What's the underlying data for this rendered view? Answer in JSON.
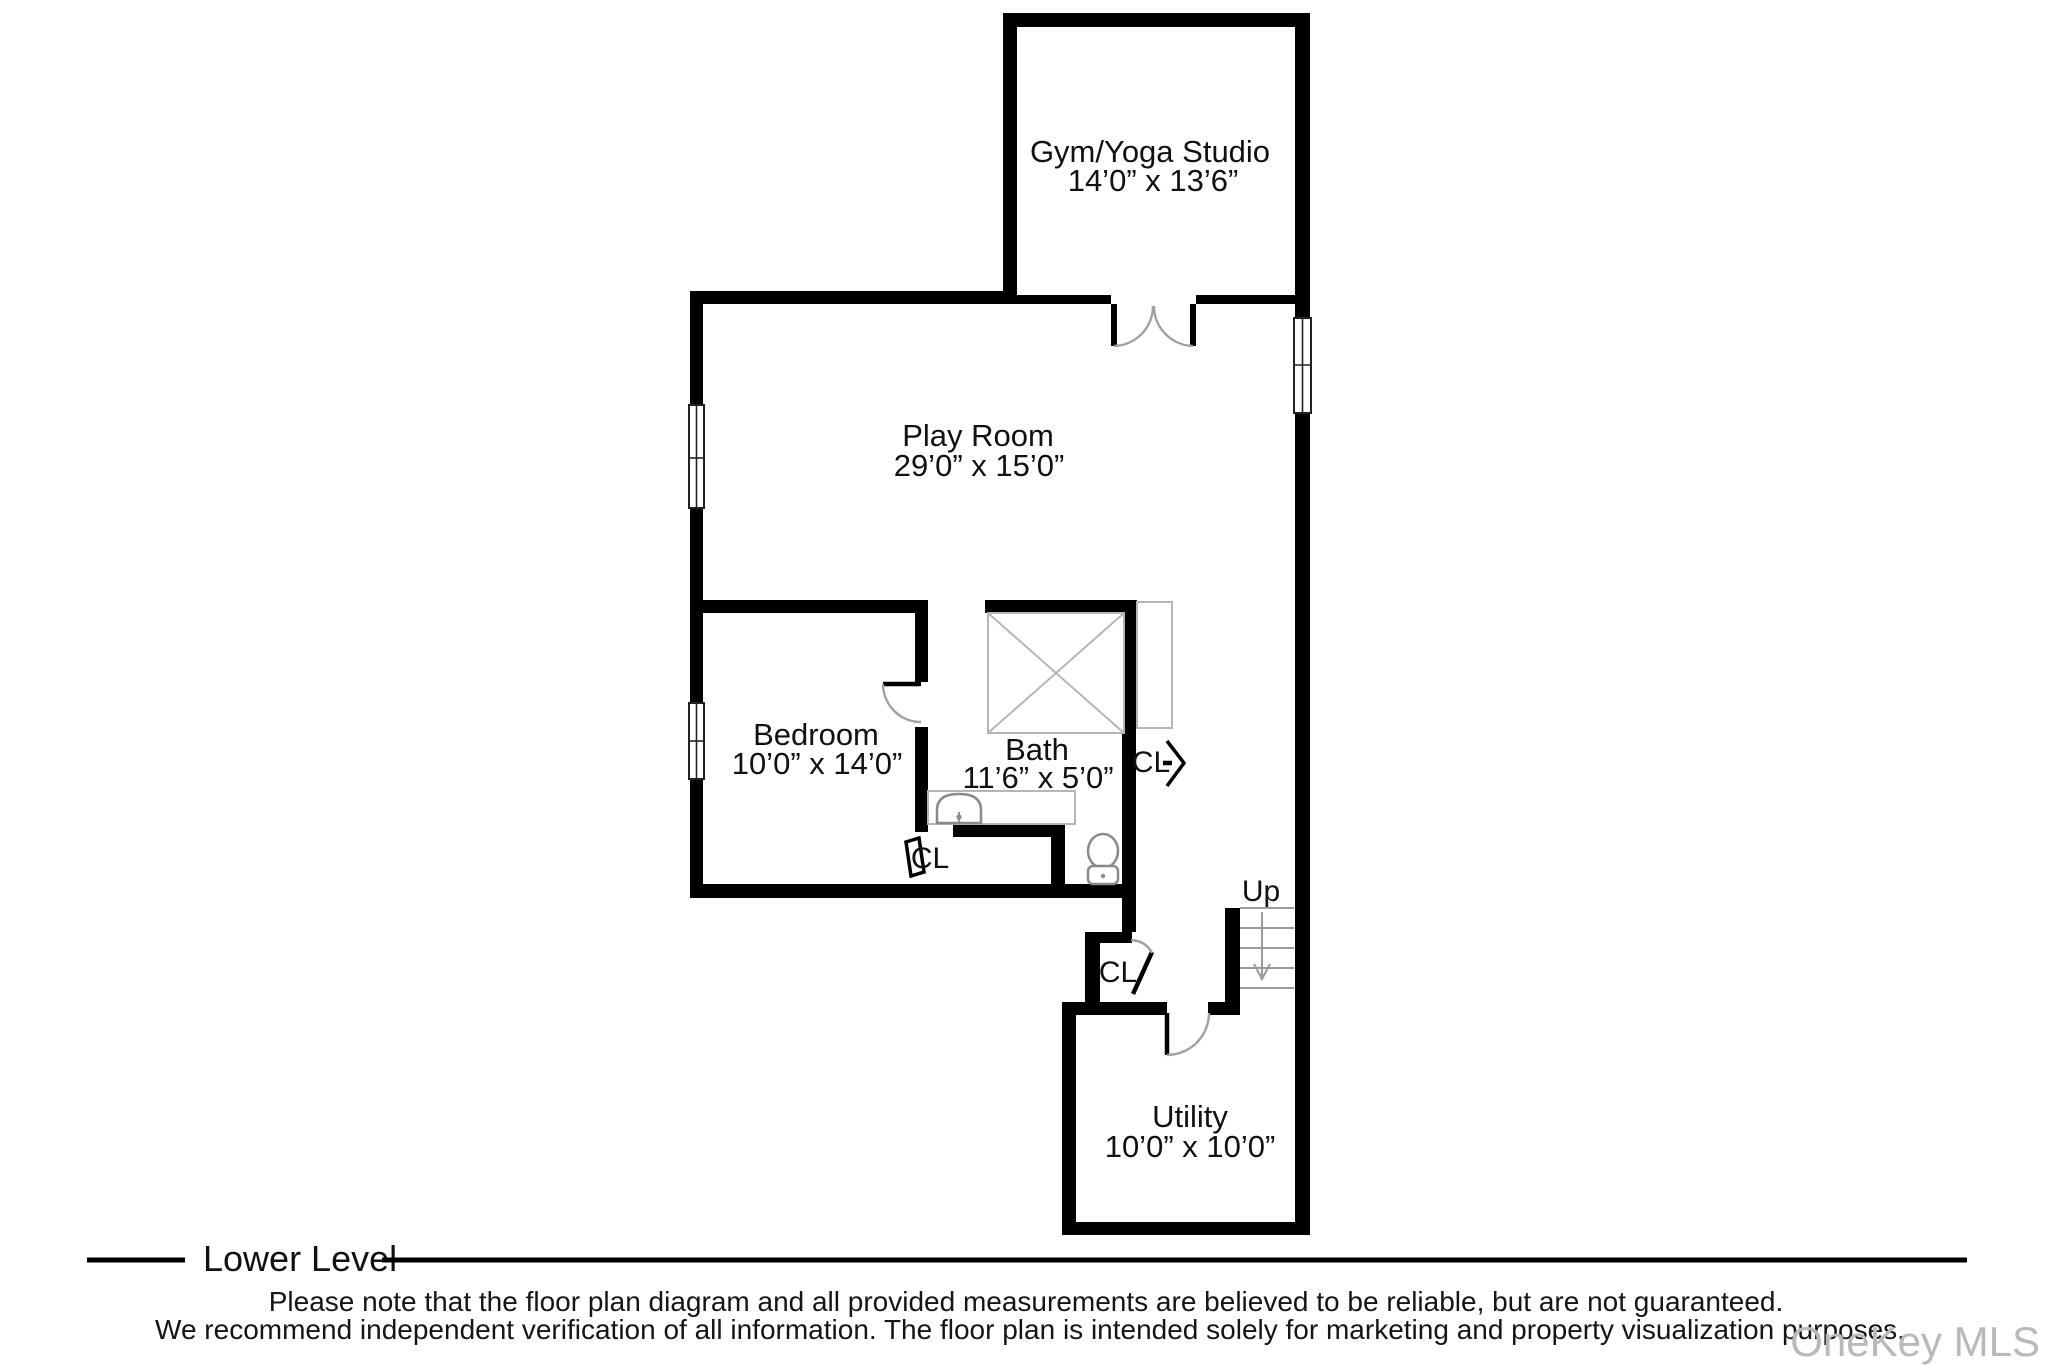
{
  "rooms": {
    "gym": {
      "name": "Gym/Yoga Studio",
      "dims": "14’0” x 13’6”"
    },
    "play": {
      "name": "Play Room",
      "dims": "29’0” x 15’0”"
    },
    "bedroom": {
      "name": "Bedroom",
      "dims": "10’0” x 14’0”"
    },
    "bath": {
      "name": "Bath",
      "dims": "11’6” x 5’0”"
    },
    "utility": {
      "name": "Utility",
      "dims": "10’0” x 10’0”"
    }
  },
  "annotations": {
    "closet_label": "CL",
    "stairs_up_label": "Up"
  },
  "footer": {
    "level_title": "Lower Level",
    "disclaimer_line1": "Please note that the floor plan diagram and all provided measurements are believed to be reliable, but are not guaranteed.",
    "disclaimer_line2": "We recommend independent verification of all information. The floor plan is intended solely for marketing and property visualization purposes.",
    "watermark": "OneKey MLS"
  },
  "colors": {
    "wall": "#000000",
    "thin_line": "#b5b5b5",
    "fixture_stroke": "#8a8a8a",
    "door_arc": "#a0a0a0",
    "text": "#111111",
    "watermark": "#b9b9b9"
  }
}
